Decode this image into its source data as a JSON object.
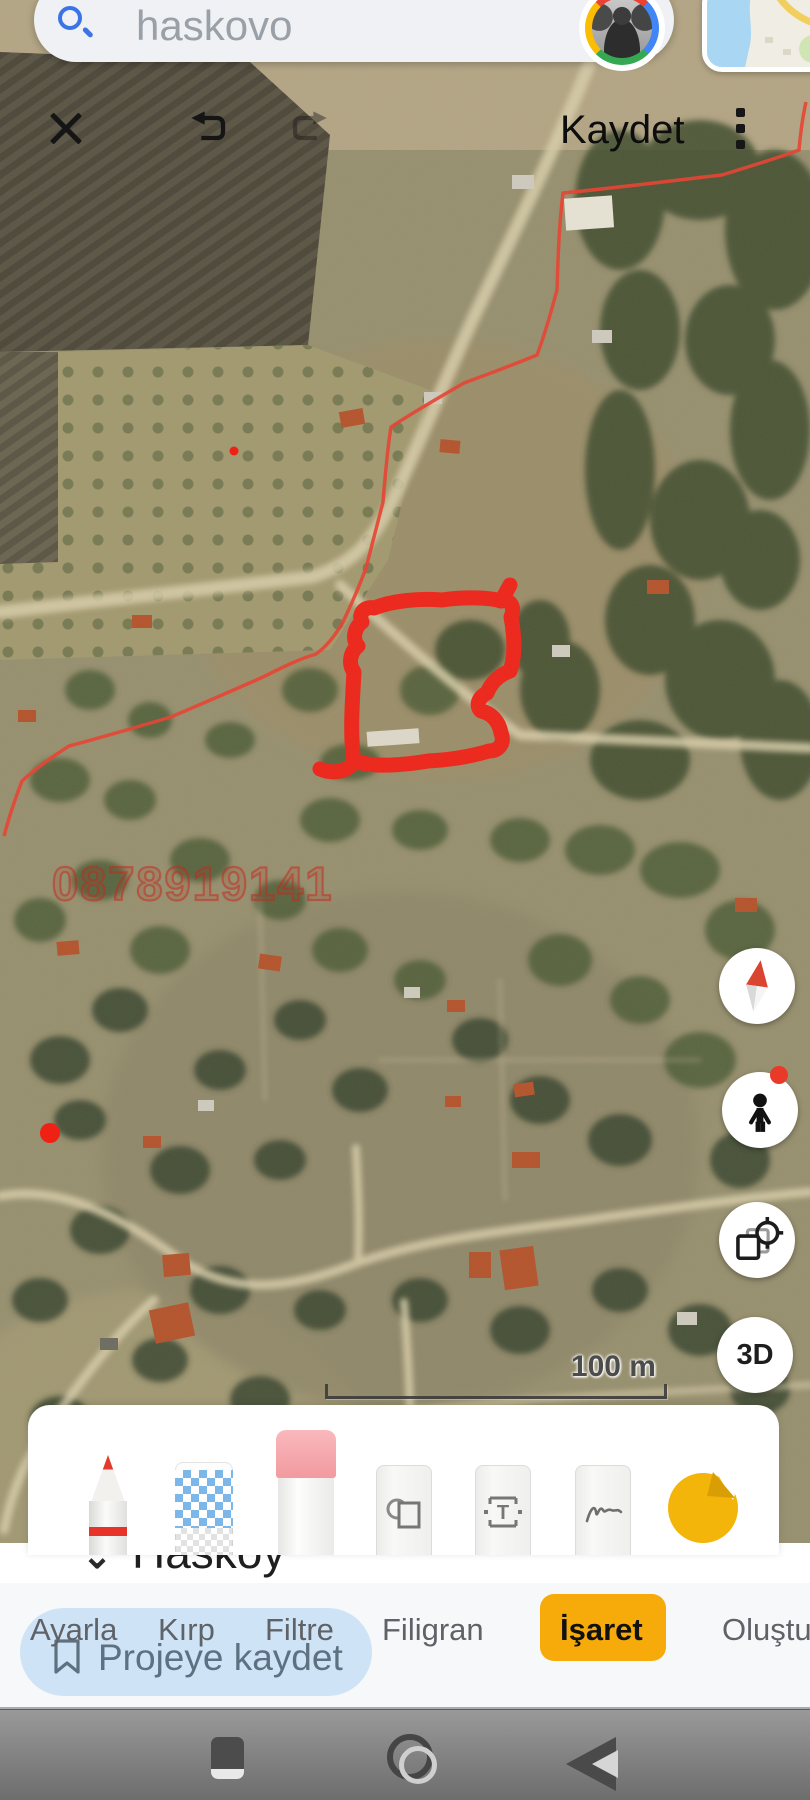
{
  "colors": {
    "accent_yellow": "#F6AB0A",
    "snackbar_blue": "#CFE3F6",
    "annotation_red": "#EE2419",
    "boundary_red": "#E8402F",
    "search_icon_blue": "#3B74E8",
    "nav_gray": "#8A8A8A"
  },
  "search": {
    "query": "haskovo"
  },
  "editor_toolbar": {
    "save_label": "Kaydet"
  },
  "map": {
    "watermark": "0878919141",
    "scale_label": "100 m",
    "underlying_place": {
      "caret": "⌄",
      "name": "Hasköy"
    },
    "controls": [
      {
        "name": "compass"
      },
      {
        "name": "street-view-pegman",
        "has_badge": true
      },
      {
        "name": "rotate-view"
      },
      {
        "name": "3d-toggle",
        "label": "3D"
      }
    ]
  },
  "palette": {
    "tools": [
      "marker-pen",
      "mosaic",
      "eraser",
      "shapes",
      "text",
      "signature",
      "sticker"
    ]
  },
  "tabs": {
    "items": [
      {
        "label": "Ayarla",
        "active": false
      },
      {
        "label": "Kırp",
        "active": false
      },
      {
        "label": "Filtre",
        "active": false
      },
      {
        "label": "Filigran",
        "active": false
      },
      {
        "label": "İşaret",
        "active": true
      },
      {
        "label": "Oluştur",
        "active": false
      }
    ]
  },
  "snackbar": {
    "label": "Projeye kaydet"
  },
  "nav": {
    "icons": [
      "recents",
      "home",
      "back"
    ]
  }
}
